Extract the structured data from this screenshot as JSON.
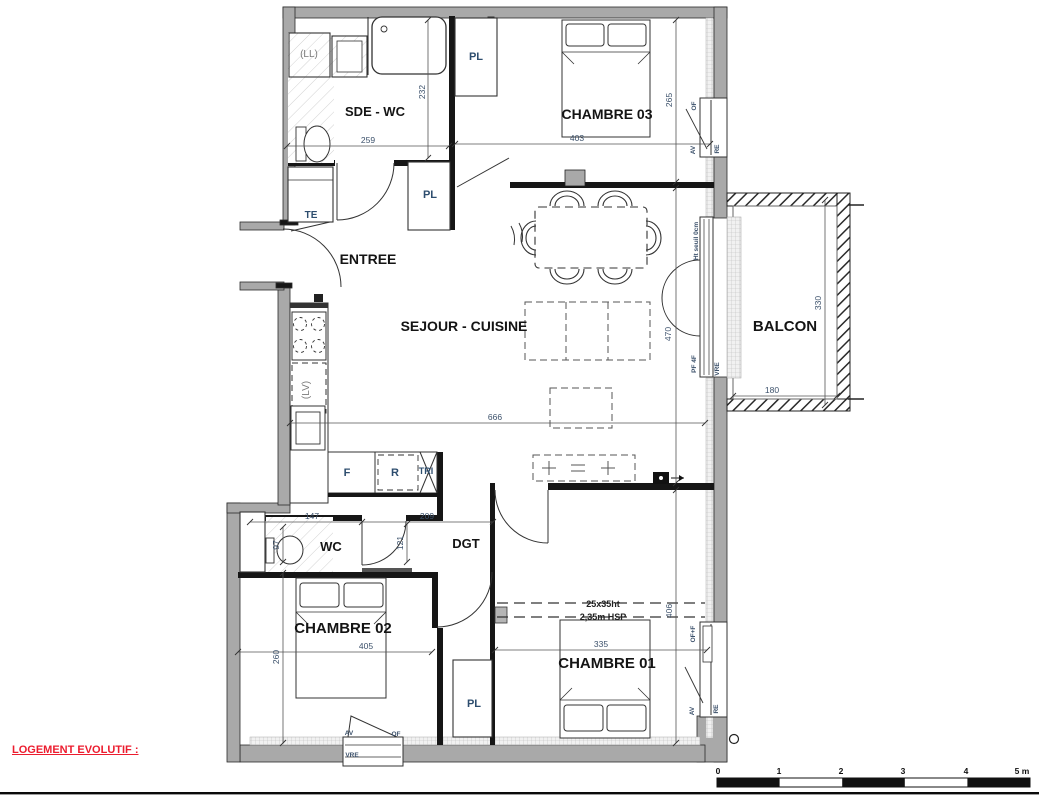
{
  "labels": {
    "rooms": {
      "sde_wc": "SDE - WC",
      "chambre03": "CHAMBRE 03",
      "entree": "ENTREE",
      "sejour_cuisine": "SEJOUR - CUISINE",
      "balcon": "BALCON",
      "wc": "WC",
      "dgt": "DGT",
      "chambre02": "CHAMBRE 02",
      "chambre01": "CHAMBRE 01"
    },
    "fixtures": {
      "washing_machine": "(LL)",
      "dishwasher": "(LV)",
      "closet_top": "PL",
      "closet_entree": "PL",
      "closet_bottom": "PL",
      "technical": "TE",
      "fridge": "F",
      "range": "R",
      "tri": "TRI"
    },
    "windows": {
      "ch03_of": "OF",
      "ch03_av": "AV",
      "ch03_re": "RE",
      "bal_seuil": "Ht seuil 0cm",
      "bal_pf": "PF 4F",
      "bal_vre": "VRE",
      "ch01_of": "OF+F",
      "ch01_av": "AV",
      "ch01_re": "RE",
      "ch02_av": "AV",
      "ch02_of": "OF",
      "ch02_vre": "VRE"
    },
    "dims": {
      "d259": "259",
      "d232": "232",
      "d403": "403",
      "d265": "265",
      "d666": "666",
      "d470": "470",
      "d330": "330",
      "d180": "180",
      "d147": "147",
      "d209": "209",
      "d121": "121",
      "d97": "97",
      "d405": "405",
      "d260": "260",
      "d335": "335",
      "d406": "406"
    },
    "beam": {
      "size": "25x35ht",
      "hsp": "2,35m HSP"
    },
    "note": "LOGEMENT EVOLUTIF :",
    "scale": {
      "s0": "0",
      "s1": "1",
      "s2": "2",
      "s3": "3",
      "s4": "4",
      "s5": "5 m"
    }
  },
  "colors": {
    "wall_gray": "#a9a9a9",
    "line_dark": "#161616",
    "label_blue": "#2d4d6e",
    "note_red": "#ec1c2e"
  }
}
